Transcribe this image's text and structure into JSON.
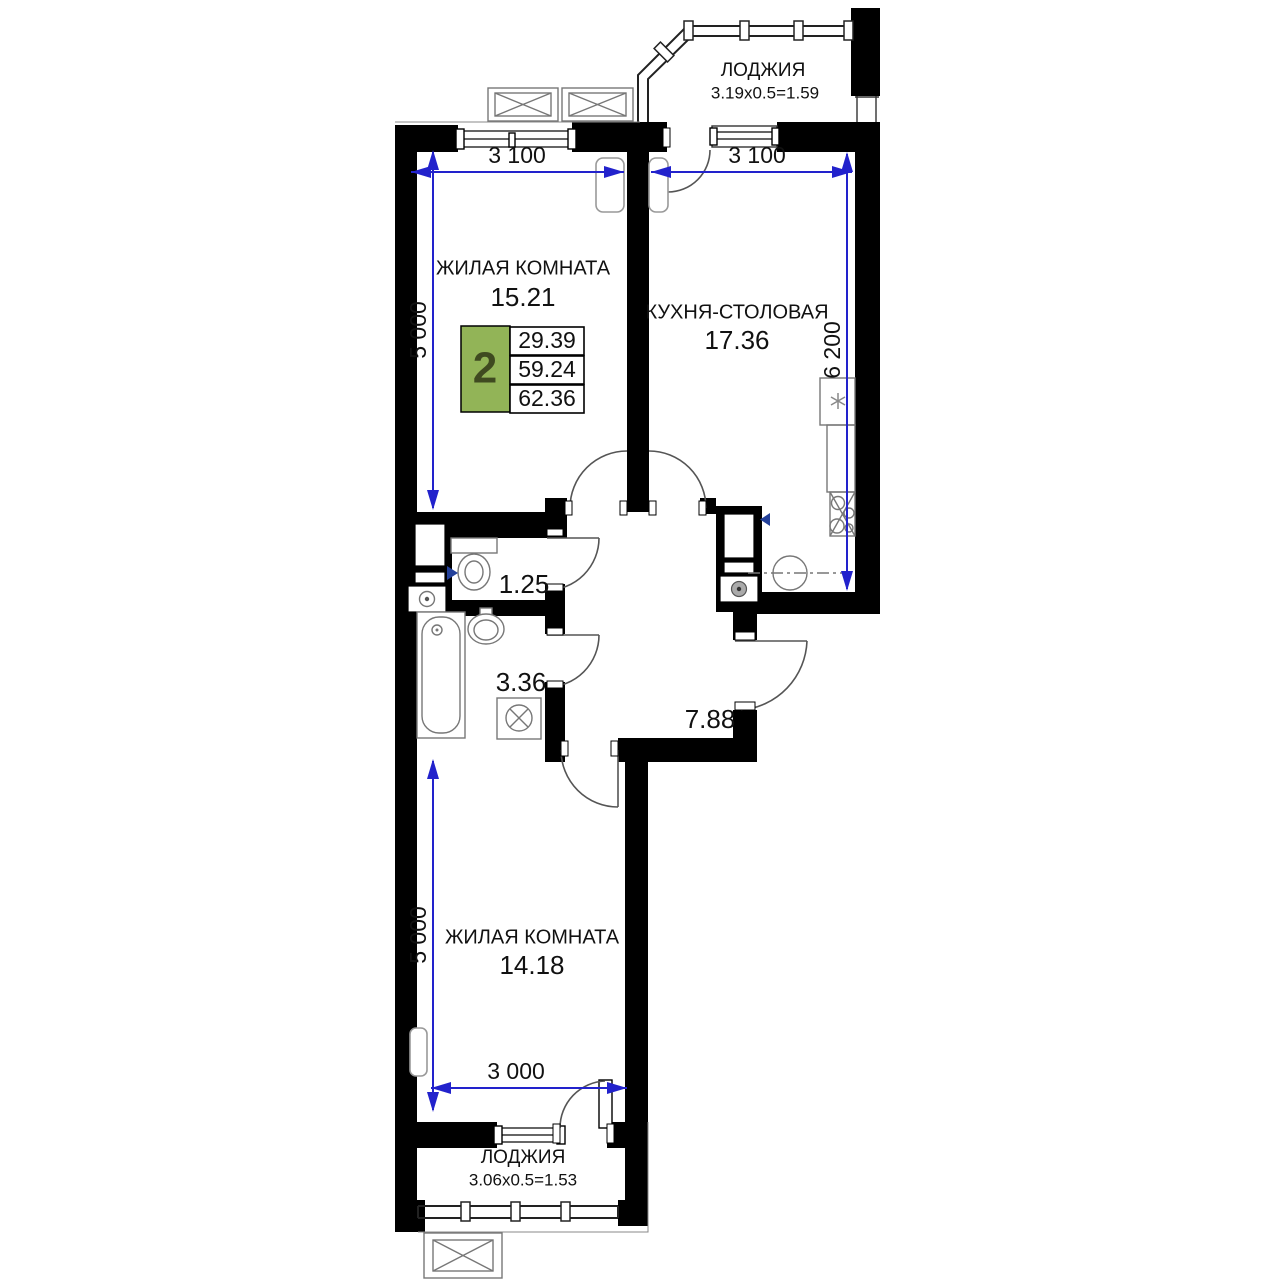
{
  "badge": {
    "rooms": "2",
    "area_living": "29.39",
    "area_main": "59.24",
    "area_total": "62.36"
  },
  "rooms": {
    "loggia_top": {
      "name": "ЛОДЖИЯ",
      "area": "3.19x0.5=1.59"
    },
    "living_top": {
      "name": "ЖИЛАЯ КОМНАТА",
      "area": "15.21"
    },
    "kitchen": {
      "name": "КУХНЯ-СТОЛОВАЯ",
      "area": "17.36"
    },
    "wc": {
      "area": "1.25"
    },
    "bath": {
      "area": "3.36"
    },
    "hall": {
      "area": "7.88"
    },
    "living_bottom": {
      "name": "ЖИЛАЯ КОМНАТА",
      "area": "14.18"
    },
    "loggia_bottom": {
      "name": "ЛОДЖИЯ",
      "area": "3.06x0.5=1.53"
    }
  },
  "dims": {
    "living_top_w": "3 100",
    "kitchen_w": "3 100",
    "living_top_h": "5 000",
    "kitchen_h": "6 200",
    "living_bottom_h": "5 000",
    "living_bottom_w": "3 000"
  },
  "colors": {
    "wall": "#000000",
    "dimension_line": "#2222cc",
    "badge_green": "#92b457",
    "badge_number": "#3f4a20"
  }
}
